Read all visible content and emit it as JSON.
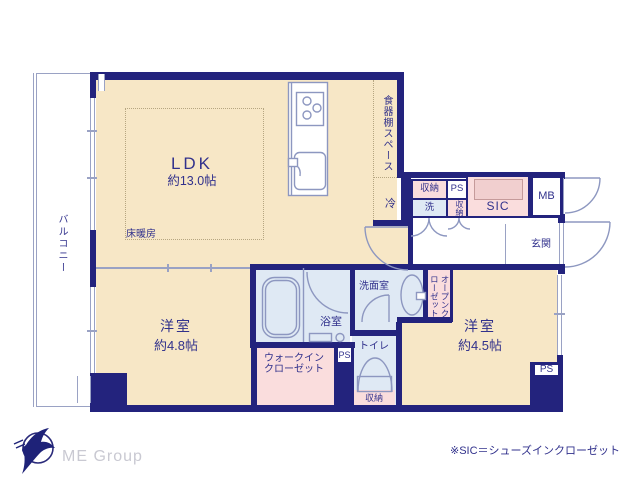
{
  "plan": {
    "ldk": {
      "name": "LDK",
      "size": "約13.0帖"
    },
    "floor_heating": "床暖房",
    "cupboard_space": "食器棚スペース",
    "fridge": "冷",
    "cabinets": {
      "storage_top": "収納",
      "washer": "洗",
      "ps": "PS",
      "storage_side": "収納",
      "sic": "SIC",
      "mb": "MB"
    },
    "entrance": "玄関",
    "open_closet": "オープンクローゼット",
    "washroom": "洗面室",
    "bathroom": "浴室",
    "toilet": "トイレ",
    "toilet_storage": "収納",
    "wic": "ウォークイン\nクローゼット",
    "room_48": {
      "name": "洋室",
      "size": "約4.8帖"
    },
    "room_45": {
      "name": "洋室",
      "size": "約4.5帖"
    },
    "ps_mid": "PS",
    "ps_bottom": "PS",
    "balcony": "バルコニー"
  },
  "footer": {
    "logo_text": "ME Group",
    "footnote": "※SIC＝シューズインクローゼット"
  },
  "colors": {
    "wall_navy": "#23237d",
    "room_beige": "#f7e7c6",
    "closet_pink": "#fadddd",
    "wet_area_blue": "#dfe9f4",
    "fixture_line": "#8d97c0",
    "label_navy": "#31318c"
  }
}
